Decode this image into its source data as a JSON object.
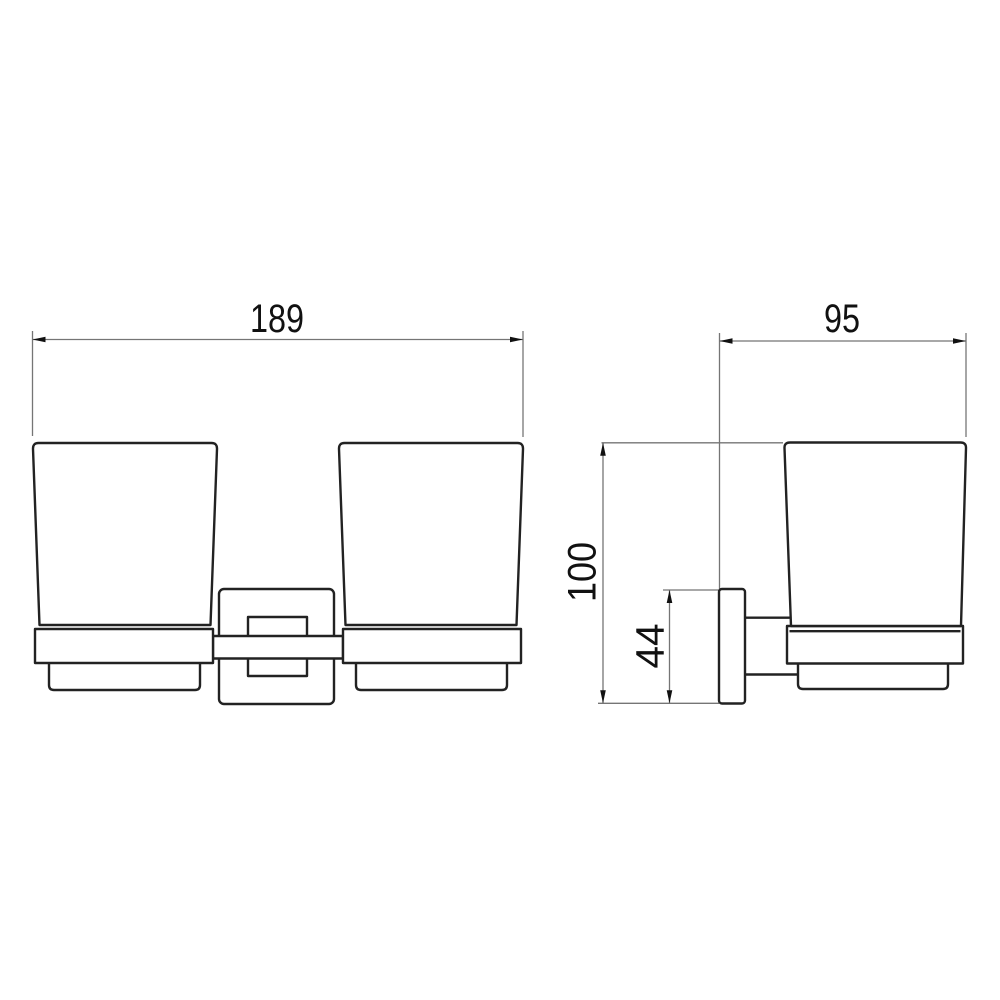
{
  "views": {
    "front": {
      "width_label": "189"
    },
    "side": {
      "depth_label": "95",
      "height_label": "100",
      "bracket_label": "44"
    }
  },
  "colors": {
    "outline": "#222222",
    "dimension_line": "#757575",
    "text": "#111111",
    "background": "#ffffff"
  }
}
